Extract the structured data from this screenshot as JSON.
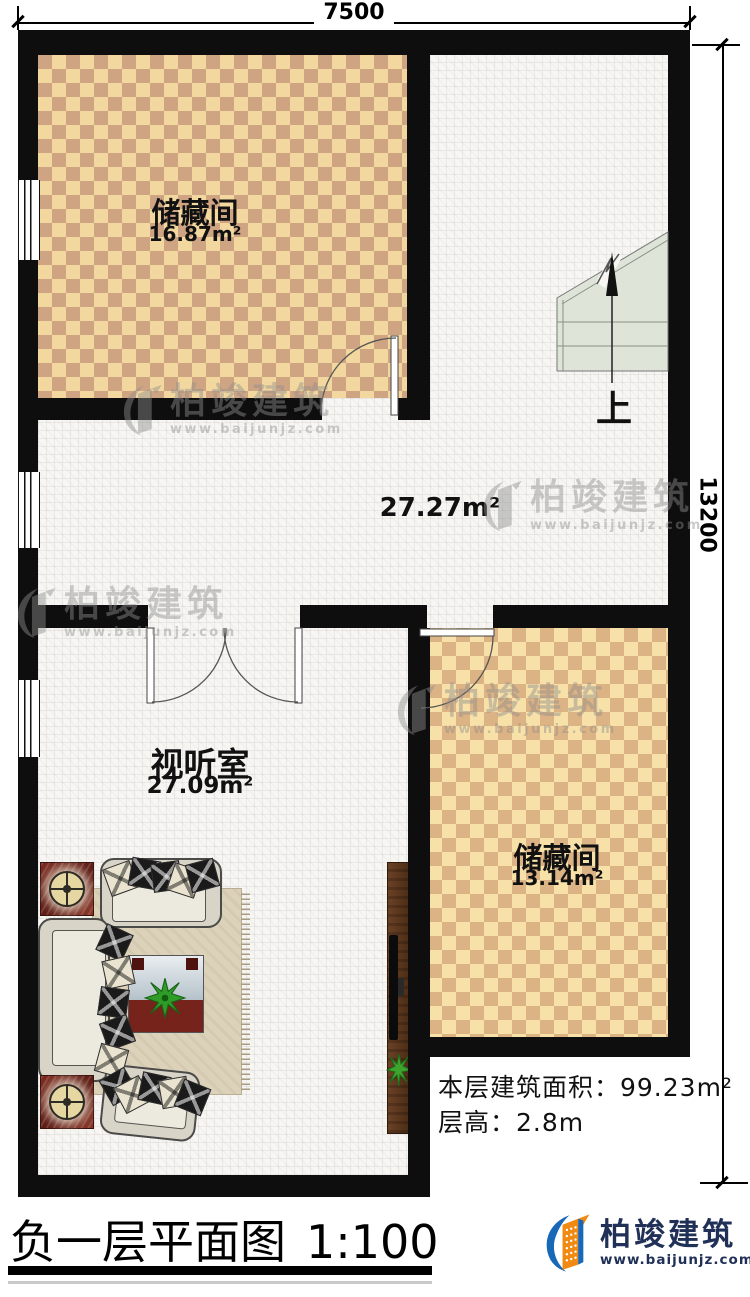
{
  "dimensions": {
    "top": "7500",
    "right": "13200"
  },
  "rooms": [
    {
      "name": "储藏间",
      "area": "16.87m²"
    },
    {
      "area": "27.27m²"
    },
    {
      "name": "视听室",
      "area": "27.09m²"
    },
    {
      "name": "储藏间",
      "area": "13.14m²"
    }
  ],
  "stairs": {
    "label": "上"
  },
  "info": {
    "line1": "本层建筑面积：99.23m²",
    "line2": "层高：2.8m"
  },
  "title": {
    "text": "负一层平面图",
    "scale": "1:100"
  },
  "brand": {
    "name": "柏竣建筑",
    "url": "www.baijunjz.com"
  },
  "watermark": {
    "name": "柏竣建筑",
    "url": "www.baijunjz.com"
  },
  "colors": {
    "wall": "#0e0e0e",
    "checker1_light": "#f2d79e",
    "checker1_dark": "#cfa482",
    "checker2_light": "#f7e1a8",
    "checker2_dark": "#dcb384",
    "stair_fill": "#dee4d8",
    "logo_blue": "#1868b8",
    "logo_orange": "#f08a12",
    "brand_navy": "#203057"
  }
}
